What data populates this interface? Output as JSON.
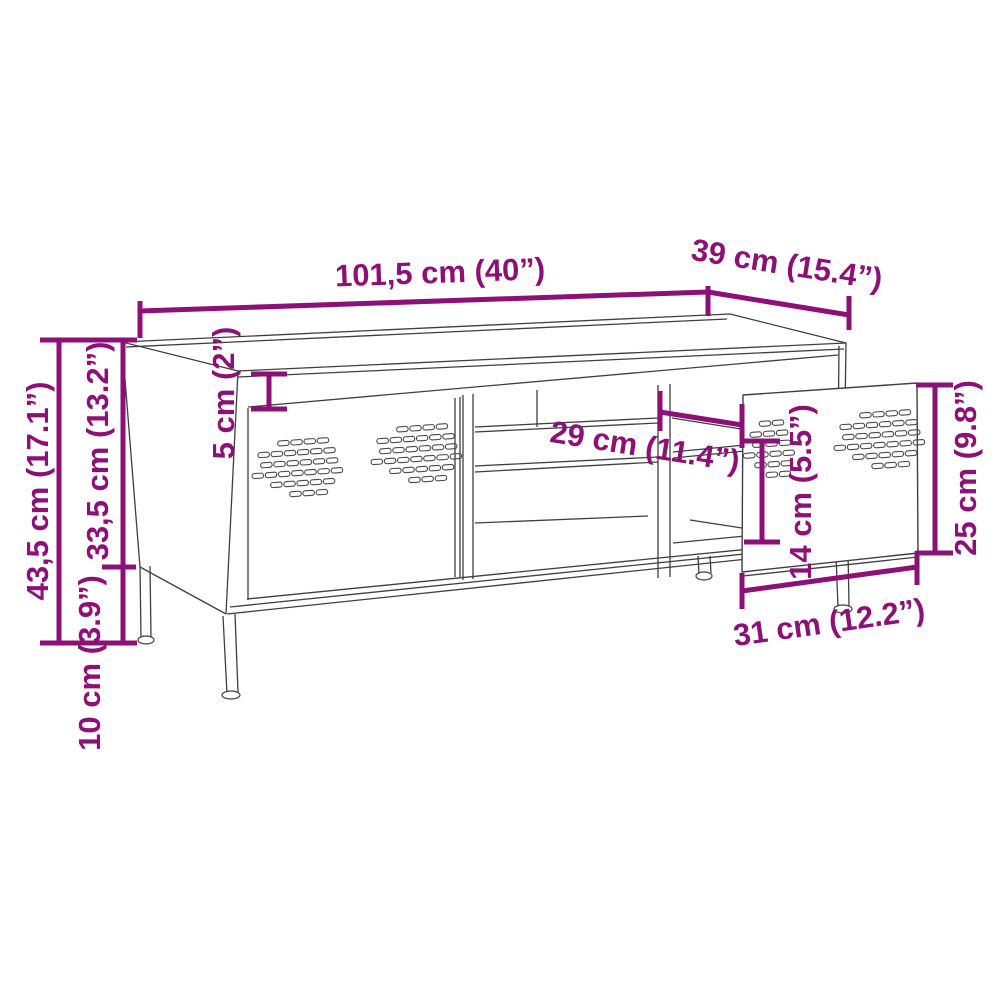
{
  "diagram": {
    "type": "furniture-dimension-diagram",
    "subject": "TV cabinet with two perforated doors, open shelves and legs",
    "accent_color": "#8d1076",
    "line_color": "#3f3f3f",
    "background_color": "#ffffff",
    "dimensions": {
      "width_top": "101,5 cm (40”)",
      "depth_top": "39 cm (15.4”)",
      "height_total": "43,5 cm (17.1”)",
      "height_body": "33,5 cm (13.2”)",
      "leg_height": "10 cm (3.9”)",
      "top_rail": "5 cm (2”)",
      "compartment_width": "29 cm (11.4”)",
      "shelf_clearance": "14 cm (5.5”)",
      "door_height": "25 cm (9.8”)",
      "door_width": "31 cm (12.2”)"
    }
  }
}
